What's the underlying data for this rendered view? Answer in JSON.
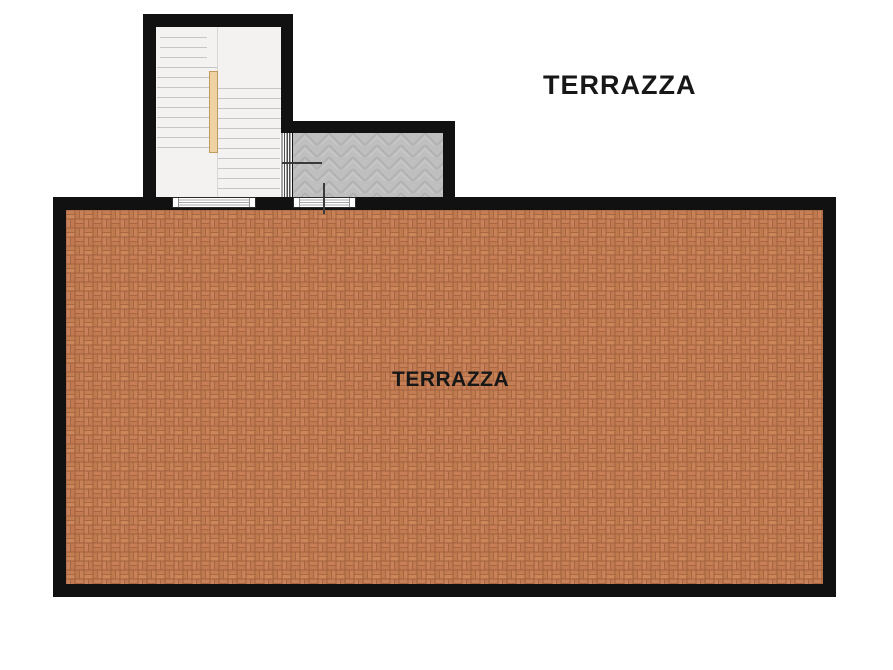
{
  "labels": {
    "upper_terrace": "TERRAZZA",
    "main_terrace": "TERRAZZA"
  },
  "areas": [
    {
      "name": "main-terrace",
      "label": "TERRAZZA",
      "floor": "terracotta-basketweave-brick"
    },
    {
      "name": "upper-landing",
      "label": "TERRAZZA",
      "floor": "gray-herringbone-tile"
    },
    {
      "name": "staircase",
      "floor": "white-stair-treads"
    }
  ],
  "colors": {
    "wall": "#111111",
    "terrace_brick": "#c47e53",
    "terrace_mortar": "#a0613e",
    "landing_tile": "#bfbfbf",
    "landing_tile_line": "#adadad",
    "stair_floor": "#f3f2f1",
    "tread_line": "#c6c6c6",
    "handrail_fill": "#eed2a2",
    "handrail_border": "#c09a5e",
    "label_text": "#171717"
  }
}
